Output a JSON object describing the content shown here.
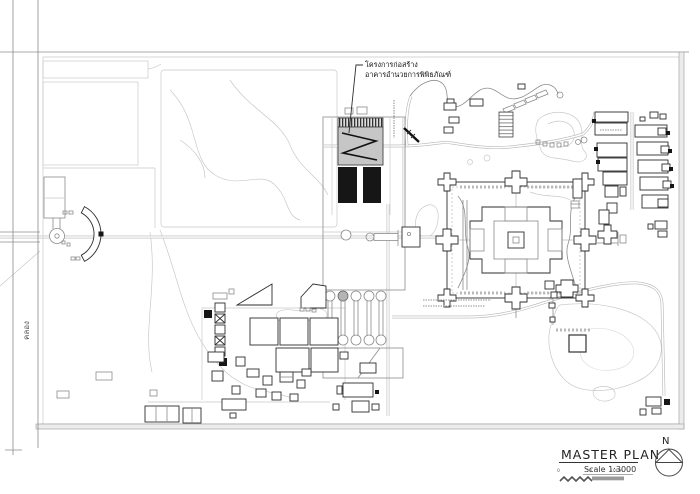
{
  "title_block": {
    "title": "MASTER PLAN",
    "scale_label": "Scale 1:3000",
    "scale_ticks": {
      "zero": "0",
      "mid": "50",
      "end": "100m."
    },
    "north_label": "N"
  },
  "annotations": {
    "construction_line1": "โครงการก่อสร้าง",
    "construction_line2": "อาคารอำนวยการพิพิธภัณฑ์",
    "canal_label": "คลอง"
  },
  "colors": {
    "paper": "#ffffff",
    "line_dark": "#2e2e2e",
    "line_mid": "#8c8c8c",
    "line_light": "#c9c9c9",
    "building_fill": "#161616",
    "roof_fill": "#c6c6c6",
    "road_edge": "#b5b5b5",
    "boundary_band": "#ececec"
  }
}
